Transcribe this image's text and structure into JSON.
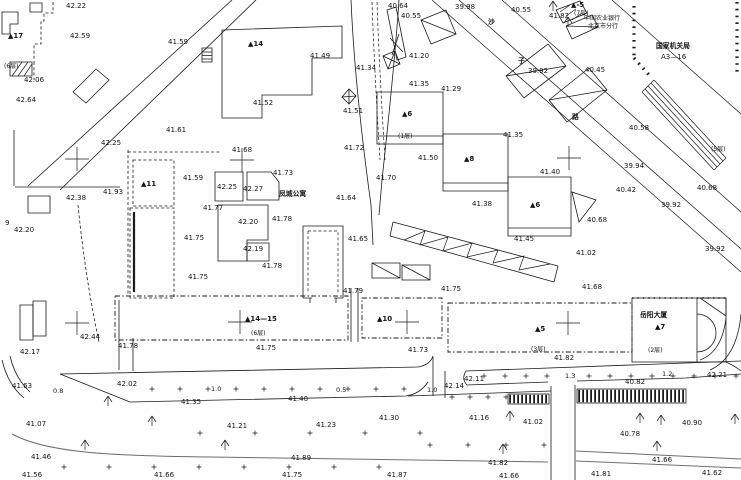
{
  "map": {
    "background_color": "#fefefe",
    "ink_color": "#1b1b1b",
    "road_edge_color": "#6f6f6f"
  },
  "labels": [
    {
      "t": "42.22",
      "x": 66,
      "y": 8
    },
    {
      "t": "42.59",
      "x": 70,
      "y": 38
    },
    {
      "t": "41.59",
      "x": 168,
      "y": 44
    },
    {
      "t": "▲17",
      "x": 8,
      "y": 38,
      "c": "bld"
    },
    {
      "t": "(6层)",
      "x": 4,
      "y": 68,
      "c": "fl"
    },
    {
      "t": "42.06",
      "x": 24,
      "y": 82
    },
    {
      "t": "42.64",
      "x": 16,
      "y": 102
    },
    {
      "t": "42.25",
      "x": 101,
      "y": 145
    },
    {
      "t": "41.61",
      "x": 166,
      "y": 132
    },
    {
      "t": "▲14",
      "x": 248,
      "y": 46,
      "c": "bld"
    },
    {
      "t": "41.49",
      "x": 310,
      "y": 58
    },
    {
      "t": "41.52",
      "x": 253,
      "y": 105
    },
    {
      "t": "41.51",
      "x": 343,
      "y": 113
    },
    {
      "t": "41.34",
      "x": 356,
      "y": 70
    },
    {
      "t": "40.64",
      "x": 388,
      "y": 8
    },
    {
      "t": "40.55",
      "x": 401,
      "y": 18
    },
    {
      "t": "41.20",
      "x": 409,
      "y": 58
    },
    {
      "t": "41.35",
      "x": 409,
      "y": 86
    },
    {
      "t": "41.29",
      "x": 441,
      "y": 91
    },
    {
      "t": "39.98",
      "x": 455,
      "y": 9
    },
    {
      "t": "40.55",
      "x": 511,
      "y": 12
    },
    {
      "t": "41.82",
      "x": 549,
      "y": 18
    },
    {
      "t": "▲-5",
      "x": 571,
      "y": 7,
      "c": "bld"
    },
    {
      "t": "(7层)",
      "x": 574,
      "y": 15,
      "c": "fl"
    },
    {
      "t": "中国农业银行",
      "x": 584,
      "y": 20,
      "c": "fl"
    },
    {
      "t": "北京市分行",
      "x": 588,
      "y": 28,
      "c": "fl"
    },
    {
      "t": "国家机关局",
      "x": 656,
      "y": 48,
      "c": "cn"
    },
    {
      "t": "A3—16",
      "x": 661,
      "y": 59
    },
    {
      "t": "沙",
      "x": 488,
      "y": 24,
      "c": "cn"
    },
    {
      "t": "子",
      "x": 518,
      "y": 63,
      "c": "cn"
    },
    {
      "t": "路",
      "x": 572,
      "y": 119,
      "c": "cn"
    },
    {
      "t": "39.92",
      "x": 528,
      "y": 73
    },
    {
      "t": "40.45",
      "x": 585,
      "y": 72
    },
    {
      "t": "40.58",
      "x": 629,
      "y": 130
    },
    {
      "t": "39.94",
      "x": 624,
      "y": 168
    },
    {
      "t": "40.42",
      "x": 616,
      "y": 192
    },
    {
      "t": "39.92",
      "x": 661,
      "y": 207
    },
    {
      "t": "40.68",
      "x": 697,
      "y": 190
    },
    {
      "t": "39.92",
      "x": 705,
      "y": 251
    },
    {
      "t": "(5层)",
      "x": 711,
      "y": 151,
      "c": "fl"
    },
    {
      "t": "41.35",
      "x": 503,
      "y": 137
    },
    {
      "t": "▲6",
      "x": 402,
      "y": 116,
      "c": "bld"
    },
    {
      "t": "▲8",
      "x": 464,
      "y": 161,
      "c": "bld"
    },
    {
      "t": "▲6",
      "x": 530,
      "y": 207,
      "c": "bld"
    },
    {
      "t": "(1层)",
      "x": 398,
      "y": 138,
      "c": "fl"
    },
    {
      "t": "41.50",
      "x": 418,
      "y": 160
    },
    {
      "t": "41.72",
      "x": 344,
      "y": 150
    },
    {
      "t": "41.70",
      "x": 376,
      "y": 180
    },
    {
      "t": "41.68",
      "x": 232,
      "y": 152
    },
    {
      "t": "41.73",
      "x": 273,
      "y": 175
    },
    {
      "t": "41.59",
      "x": 183,
      "y": 180
    },
    {
      "t": "42.25",
      "x": 217,
      "y": 189
    },
    {
      "t": "42.27",
      "x": 243,
      "y": 191
    },
    {
      "t": "41.77",
      "x": 203,
      "y": 210
    },
    {
      "t": "42.20",
      "x": 238,
      "y": 224
    },
    {
      "t": "41.78",
      "x": 272,
      "y": 221
    },
    {
      "t": "41.75",
      "x": 184,
      "y": 240
    },
    {
      "t": "42.19",
      "x": 243,
      "y": 251
    },
    {
      "t": "41.78",
      "x": 262,
      "y": 268
    },
    {
      "t": "41.75",
      "x": 188,
      "y": 279
    },
    {
      "t": "凤城公寓",
      "x": 279,
      "y": 196,
      "c": "cn"
    },
    {
      "t": "41.64",
      "x": 336,
      "y": 200
    },
    {
      "t": "41.65",
      "x": 348,
      "y": 241
    },
    {
      "t": "41.79",
      "x": 343,
      "y": 293
    },
    {
      "t": "41.93",
      "x": 103,
      "y": 194
    },
    {
      "t": "42.38",
      "x": 66,
      "y": 200
    },
    {
      "t": "42.20",
      "x": 14,
      "y": 232
    },
    {
      "t": "9",
      "x": 5,
      "y": 225
    },
    {
      "t": "▲11",
      "x": 141,
      "y": 186,
      "c": "bld"
    },
    {
      "t": "41.38",
      "x": 472,
      "y": 206
    },
    {
      "t": "41.40",
      "x": 540,
      "y": 174
    },
    {
      "t": "41.45",
      "x": 514,
      "y": 241
    },
    {
      "t": "40.68",
      "x": 587,
      "y": 222
    },
    {
      "t": "41.02",
      "x": 576,
      "y": 255
    },
    {
      "t": "41.68",
      "x": 582,
      "y": 289
    },
    {
      "t": "41.75",
      "x": 441,
      "y": 291
    },
    {
      "t": "▲14—15",
      "x": 245,
      "y": 321,
      "c": "bld"
    },
    {
      "t": "(6层)",
      "x": 251,
      "y": 335,
      "c": "fl"
    },
    {
      "t": "41.75",
      "x": 256,
      "y": 350
    },
    {
      "t": "▲10",
      "x": 377,
      "y": 321,
      "c": "bld"
    },
    {
      "t": "41.73",
      "x": 408,
      "y": 352
    },
    {
      "t": "▲5",
      "x": 535,
      "y": 331,
      "c": "bld"
    },
    {
      "t": "(3层)",
      "x": 531,
      "y": 351,
      "c": "fl"
    },
    {
      "t": "41.82",
      "x": 554,
      "y": 360
    },
    {
      "t": "岳阳大厦",
      "x": 640,
      "y": 317,
      "c": "cn"
    },
    {
      "t": "▲7",
      "x": 655,
      "y": 329,
      "c": "bld"
    },
    {
      "t": "(2层)",
      "x": 648,
      "y": 352,
      "c": "fl"
    },
    {
      "t": "42.44",
      "x": 80,
      "y": 339
    },
    {
      "t": "42.17",
      "x": 20,
      "y": 354
    },
    {
      "t": "41.78",
      "x": 118,
      "y": 348
    },
    {
      "t": "41.63",
      "x": 12,
      "y": 388
    },
    {
      "t": "0.8",
      "x": 53,
      "y": 393,
      "c": "dim"
    },
    {
      "t": "42.02",
      "x": 117,
      "y": 386
    },
    {
      "t": "1.0",
      "x": 211,
      "y": 391,
      "c": "dim"
    },
    {
      "t": "41.35",
      "x": 181,
      "y": 404
    },
    {
      "t": "0.5",
      "x": 336,
      "y": 392,
      "c": "dim"
    },
    {
      "t": "41.40",
      "x": 288,
      "y": 401
    },
    {
      "t": "42.14",
      "x": 444,
      "y": 388
    },
    {
      "t": "1.0",
      "x": 427,
      "y": 392,
      "c": "dim"
    },
    {
      "t": "42.11",
      "x": 464,
      "y": 381
    },
    {
      "t": "1.3",
      "x": 565,
      "y": 378,
      "c": "dim"
    },
    {
      "t": "1.2",
      "x": 662,
      "y": 376,
      "c": "dim"
    },
    {
      "t": "42.21",
      "x": 707,
      "y": 377
    },
    {
      "t": "40.82",
      "x": 625,
      "y": 384
    },
    {
      "t": "41.07",
      "x": 26,
      "y": 426
    },
    {
      "t": "41.21",
      "x": 227,
      "y": 428
    },
    {
      "t": "41.23",
      "x": 316,
      "y": 427
    },
    {
      "t": "41.30",
      "x": 379,
      "y": 420
    },
    {
      "t": "41.16",
      "x": 469,
      "y": 420
    },
    {
      "t": "41.02",
      "x": 523,
      "y": 424
    },
    {
      "t": "40.90",
      "x": 682,
      "y": 425
    },
    {
      "t": "40.78",
      "x": 620,
      "y": 436
    },
    {
      "t": "41.46",
      "x": 31,
      "y": 459
    },
    {
      "t": "41.89",
      "x": 291,
      "y": 460
    },
    {
      "t": "41.82",
      "x": 488,
      "y": 465
    },
    {
      "t": "41.66",
      "x": 652,
      "y": 462
    },
    {
      "t": "41.56",
      "x": 22,
      "y": 477
    },
    {
      "t": "41.66",
      "x": 154,
      "y": 477
    },
    {
      "t": "41.75",
      "x": 282,
      "y": 477
    },
    {
      "t": "41.87",
      "x": 387,
      "y": 477
    },
    {
      "t": "41.66",
      "x": 499,
      "y": 478
    },
    {
      "t": "41.81",
      "x": 591,
      "y": 476
    },
    {
      "t": "41.62",
      "x": 702,
      "y": 475
    }
  ],
  "symbols": {
    "crosses": [
      [
        77,
        159
      ],
      [
        242,
        160
      ],
      [
        569,
        158
      ],
      [
        77,
        323
      ],
      [
        240,
        322
      ],
      [
        407,
        322
      ],
      [
        568,
        323
      ]
    ],
    "trees": [
      [
        553,
        6
      ],
      [
        568,
        22
      ],
      [
        108,
        401
      ],
      [
        152,
        421
      ],
      [
        85,
        445
      ],
      [
        225,
        445
      ],
      [
        510,
        416
      ],
      [
        640,
        418
      ],
      [
        661,
        420
      ],
      [
        503,
        449
      ],
      [
        657,
        446
      ],
      [
        735,
        419
      ]
    ],
    "plus_rows": [
      {
        "y": 389,
        "x0": 152,
        "x1": 404,
        "step": 28
      },
      {
        "y": 376,
        "x0": 484,
        "x1": 547,
        "step": 21
      },
      {
        "y": 376,
        "x0": 589,
        "x1": 740,
        "step": 21
      },
      {
        "y": 397,
        "x0": 452,
        "x1": 506,
        "step": 18
      },
      {
        "y": 467,
        "x0": 64,
        "x1": 380,
        "step": 45
      },
      {
        "y": 433,
        "x0": 200,
        "x1": 420,
        "step": 55
      },
      {
        "y": 445,
        "x0": 430,
        "x1": 545,
        "step": 38
      }
    ],
    "zebras": [
      {
        "x": 508,
        "y": 394,
        "w": 41,
        "h": 10,
        "step": 4
      },
      {
        "x": 577,
        "y": 389,
        "w": 109,
        "h": 14,
        "step": 4
      }
    ]
  }
}
